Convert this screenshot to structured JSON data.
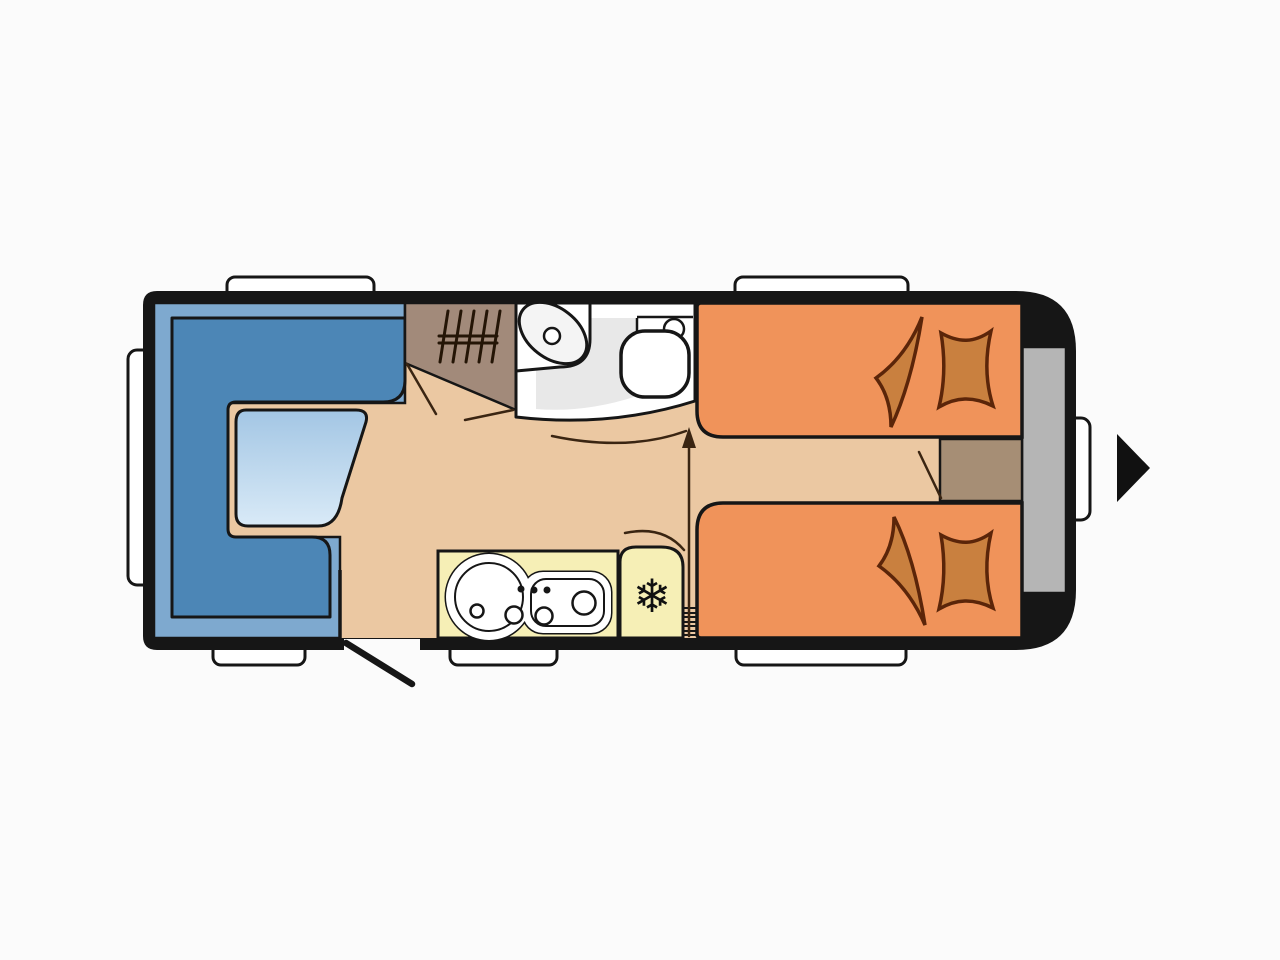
{
  "page": {
    "background": "#fbfbfb"
  },
  "floorplan": {
    "type": "caravan-floor-plan",
    "symbols": {
      "snowflake": "❄"
    },
    "colors": {
      "body": "#161616",
      "floor": "#ebc8a2",
      "window_white": "#ffffff",
      "lounge_base": "#7ea9cf",
      "lounge_seat": "#4c86b6",
      "table_top": "#a3c6e4",
      "table_bottom": "#d9eaf7",
      "wardrobe": "#a28a7a",
      "bath_floor": "#e8e8e8",
      "fixture_white": "#ffffff",
      "fixture_light": "#f4f4f4",
      "bed": "#f0935a",
      "bedding": "#c9803f",
      "bedding_line": "#5b2509",
      "kitchen": "#f6efb6",
      "storage_gray": "#b5b5b5",
      "cabinet": "#a68e75",
      "floor_line": "#3a2512",
      "arrow_black": "#111111"
    }
  }
}
